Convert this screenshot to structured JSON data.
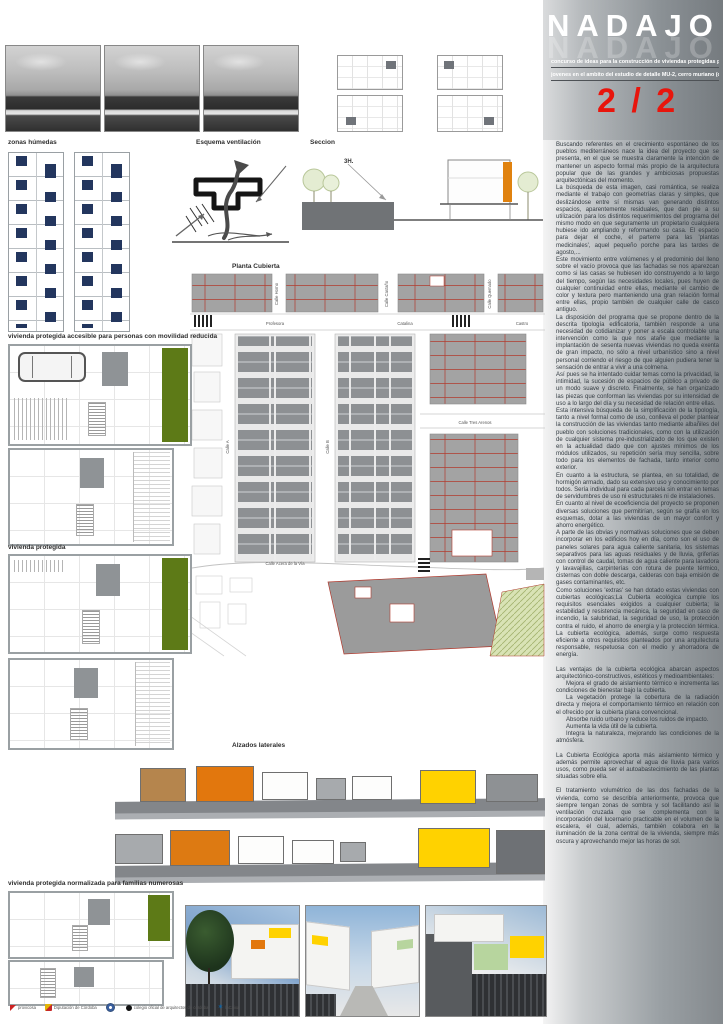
{
  "header": {
    "title": "NADAJO",
    "subtitle_line1": "concurso de ideas para la construcción de viviendas protegidas para",
    "subtitle_line2": "jovenes en el ambito del estudio de detalle MU-2, cerro muriano (cordoba)",
    "sheet_index": "2 / 2"
  },
  "section_labels": {
    "zonas_humedas": "zonas húmedas",
    "esquema_ventilacion": "Esquema ventilación",
    "seccion": "Seccion",
    "seccion_annotation": "3H.",
    "planta_cubierta": "Planta Cubierta",
    "vivienda_accesible": "vivienda protegida accesible para personas con movilidad reducida",
    "vivienda_protegida": "vivienda protegida",
    "alzados_laterales": "Alzados laterales",
    "vivienda_numerosas": "vivienda protegida  normalizada para familias numerosas"
  },
  "site_plan": {
    "streets": [
      {
        "label": "Calle Horno"
      },
      {
        "label": "Calle Castaño"
      },
      {
        "label": "Calle Quemado"
      },
      {
        "label": "Profesora"
      },
      {
        "label": "Catalina"
      },
      {
        "label": "Castro"
      },
      {
        "label": "Calle A"
      },
      {
        "label": "Calle B"
      },
      {
        "label": "Calle Tres Arenos"
      },
      {
        "label": "Calle  Acera  de  la  Vía"
      }
    ]
  },
  "memoria": {
    "blocks": [
      {
        "text": "Buscando referentes en el crecimiento espontáneo de los pueblos mediterráneos nace la idea del proyecto que se presenta, en el que se muestra claramente la intención de mantener un aspecto formal más propio de la arquitectura popular que de las grandes y ambiciosas propuestas arquitectónicas del momento."
      },
      {
        "text": "La búsqueda de esta imagen, casi romántica, se realiza mediante el trabajo con geometrías claras y simples, que deslizándose entre sí mismas van generando distintos espacios, aparentemente residuales, que dan pie a su utilización para los distintos requerimientos del programa del mismo modo en que seguramente un propietario cualquiera hubiese ido ampliando y reformando su casa. El espacio para dejar el coche, el parterre para las 'plantas medicinales', aquel pequeño porche para las tardes de agosto,..."
      },
      {
        "text": "Este movimiento entre volúmenes y el predominio del lleno sobre el vacío provoca que las fachadas se nos aparezcan como si las casas se hubiesen ido construyendo a lo largo del tiempo, según las necesidades locales, pues huyen de cualquier continuidad entre ellas, mediante el cambio de color y textura pero manteniendo una gran relación formal entre ellas, propio también de cualquier calle de casco antiguo."
      },
      {
        "text": "La disposición del programa que se propone dentro de la descrita tipología edificatoria, también responde a una necesidad de cotidianizar y poner a escala controlable una intervención como la que nos atañe que mediante la implantación de sesenta nuevas viviendas no queda exenta de gran impacto, no sólo a nivel urbanístico sino a nivel personal corriendo el riesgo de que alguien pudiera tener la sensación de entrar a vivir a una colmena."
      },
      {
        "text": "Así pues se ha intentado cuidar temas como la privacidad, la intimidad, la sucesión de espacios de público a privado de un modo suave y discreto. Finalmente, se han organizado las piezas que conforman las viviendas por su intensidad de uso a lo largo del día y su necesidad de relación entre ellas."
      },
      {
        "text": "Esta intensiva búsqueda de la simplificación de la tipología, tanto a nivel formal como de uso, conlleva el poder plantear la construcción de las viviendas tanto mediante albañiles del pueblo con soluciones tradicionales, como con la utilización de cualquier sistema pre-industrializado de los que existen en la actualidad dado que con ajustes mínimos de los módulos utilizados, su repetición sería muy sencilla, sobre todo para los elementos de fachada, tanto interior como exterior."
      },
      {
        "text": "En cuanto a la estructura, se plantea, en su totalidad, de hormigón armado, dado su extensivo uso y conocimiento por todos. Sería individual para cada parcela sin entrar en temas de servidumbres de uso ni estructurales ni de instalaciones."
      },
      {
        "text": "En cuanto al nivel de ecoeficiencia del proyecto se proponen diversas soluciones que permitirían, según se grafía en los esquemas, dotar a las viviendas de un mayor confort y ahorro energético."
      },
      {
        "text": "A parte de las obvias y normativas soluciones que se deben incorporar en los edificios hoy en día, como son el uso de paneles solares para agua caliente sanitaria, los sistemas separativos para las aguas residuales y de lluvia, griferías con control de caudal, tomas de agua caliente para lavadora y lavavajillas, carpinterías con rotura de puente térmico, cisternas con doble descarga, calderas con baja emisión de gases contaminantes, etc."
      },
      {
        "text": "Como soluciones 'extras' se han dotado estas viviendas con cubiertas ecológicas;La Cubierta ecológica cumple los requisitos esenciales exigidos a cualquier cubierta; la estabilidad y resistencia mecánica, la seguridad en caso de incendio, la salubridad, la seguridad de uso, la protección contra el ruido, el ahorro de energía y la protección térmica. La cubierta ecológica, además, surge como respuesta eficiente a otros requisitos planteados por una arquitectura responsable, respetuosa con el medio y ahorradora de energía."
      },
      {
        "text": "Las ventajas de la cubierta ecológica abarcan aspectos arquitectónico-constructivos, estéticos y medioambientales:",
        "gap": true
      },
      {
        "text": "Mejora el grado de aislamiento térmico e incrementa las condiciones de bienestar bajo la cubierta.",
        "indent": true
      },
      {
        "text": "La vegetación protege la cobertura de la radiación directa y mejora el comportamiento térmico en relación con el ofrecido por la cubierta plana convencional.",
        "indent": true
      },
      {
        "text": "Absorbe ruido urbano y reduce los ruidos de impacto.",
        "indent": true
      },
      {
        "text": "Aumenta la vida útil de la cubierta.",
        "indent": true
      },
      {
        "text": "Integra la naturaleza, mejorando las condiciones de la atmósfera.",
        "indent": true
      },
      {
        "text": "La Cubierta Ecológica aporta más aislamiento térmico y además permite aprovechar el agua de lluvia para varios usos, como pueda ser el autoabastecimiento de las plantas situadas sobre ella.",
        "gap": true
      },
      {
        "text": "El tratamiento volumétrico de las dos fachadas de la vivienda, como se describía anteriormente, provoca que siempre tengan zonas de sombra y sol facilitando así la ventilación cruzada que se complementa con la incorporación del lucernario practicable en el volumen de la escalera, el cual, además, también colabora en la iluminación de la zona central de la vivienda, siempre más oscura y aprovechando mejor las horas de sol.",
        "gap": true
      }
    ]
  },
  "palette": {
    "accent_red": "#e8150c",
    "garden_green": "#5d7a17",
    "elevation_orange": "#e2770d",
    "elevation_yellow": "#ffd200",
    "elevation_tan": "#b5854d",
    "roof_gray": "#a3a3a3",
    "roof_line_red": "#b23b2e",
    "humedas_navy": "#23365e"
  },
  "footer": {
    "logos": [
      {
        "label": "provicosa"
      },
      {
        "label": "Diputación de Córdoba"
      },
      {
        "label": ""
      },
      {
        "label": "colegio oficial de arquitectos de córdoba"
      },
      {
        "label": "laCaixa"
      }
    ]
  }
}
